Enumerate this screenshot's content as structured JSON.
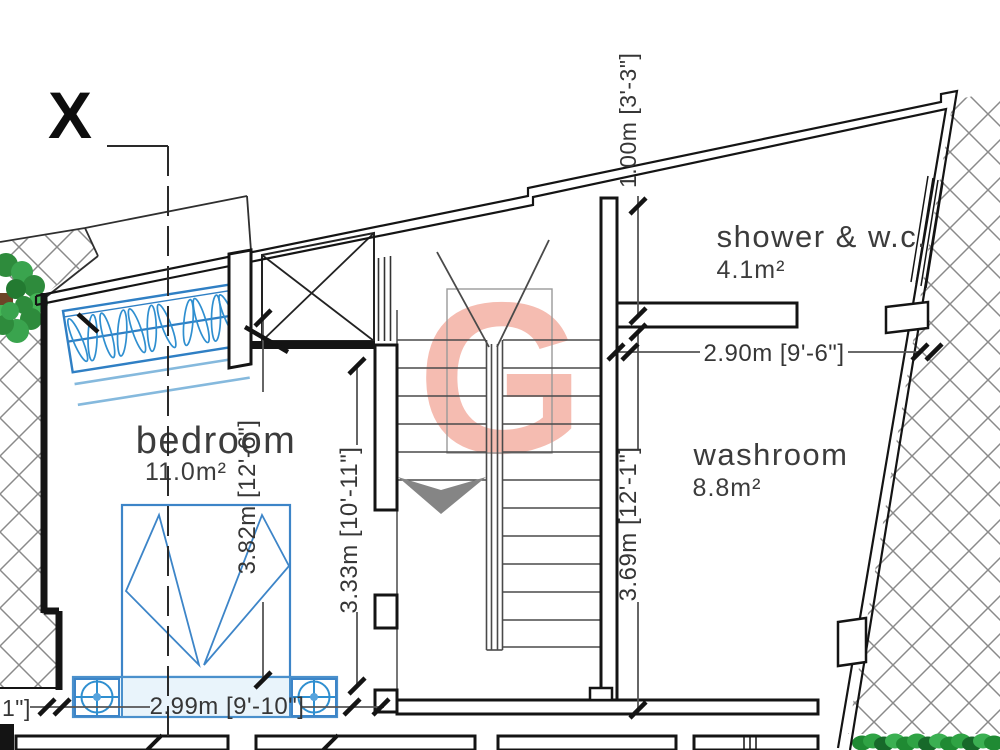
{
  "title": "first floor plan",
  "section_marker": {
    "label": "X"
  },
  "watermark": {
    "letter": "G",
    "color": "#f5bcb1"
  },
  "rooms": [
    {
      "name": "bedroom",
      "area": "11.0m²"
    },
    {
      "name": "shower & w.c.",
      "area": "4.1m²"
    },
    {
      "name": "washroom",
      "area": "8.8m²"
    }
  ],
  "dimensions": {
    "bedroom_width": "2.99m [9'-10\"]",
    "bedroom_depth": "3.82m [12'-6\"]",
    "hall_depth": "3.33m [10'-11\"]",
    "shower_depth": "1.00m [3'-3\"]",
    "washroom_width": "2.90m [9'-6\"]",
    "washroom_depth": "3.69m [12'-1\"]",
    "clipped_left": "1\"]"
  },
  "colors": {
    "wall": "#141414",
    "furniture_blue": "#3d85c8",
    "watermark_pink": "#f5bcb1",
    "hatch_gray": "#8a8a8a",
    "tree_green": "#2e8b3c",
    "label_gray": "#3c3c3c"
  }
}
